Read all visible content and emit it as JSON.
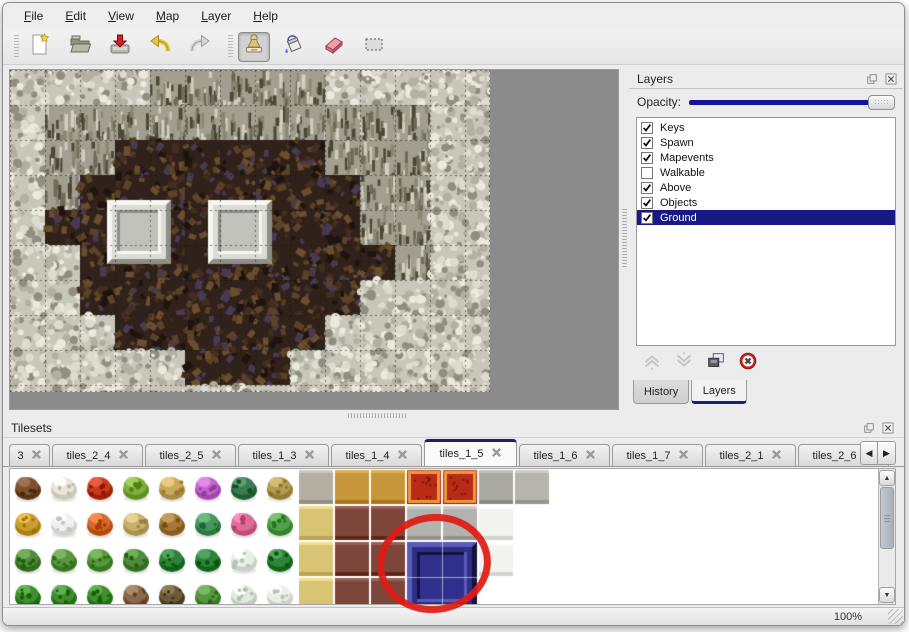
{
  "menu": {
    "items": [
      "File",
      "Edit",
      "View",
      "Map",
      "Layer",
      "Help"
    ]
  },
  "toolbar": {
    "groups": [
      [
        "new-file",
        "open-file",
        "save-file",
        "undo",
        "redo"
      ],
      [
        "stamp-tool",
        "fill-tool",
        "eraser-tool",
        "select-tool"
      ]
    ],
    "active_tool": "stamp-tool"
  },
  "layers_panel": {
    "title": "Layers",
    "opacity_label": "Opacity:",
    "float_icon": "float-icon",
    "close_icon": "close-icon",
    "layers": [
      {
        "label": "Keys",
        "checked": true,
        "selected": false
      },
      {
        "label": "Spawn",
        "checked": true,
        "selected": false
      },
      {
        "label": "Mapevents",
        "checked": true,
        "selected": false
      },
      {
        "label": "Walkable",
        "checked": false,
        "selected": false
      },
      {
        "label": "Above",
        "checked": true,
        "selected": false
      },
      {
        "label": "Objects",
        "checked": true,
        "selected": false
      },
      {
        "label": "Ground",
        "checked": true,
        "selected": true
      }
    ],
    "buttons": [
      {
        "icon": "move-up-icon",
        "enabled": false
      },
      {
        "icon": "move-down-icon",
        "enabled": false
      },
      {
        "icon": "duplicate-icon",
        "enabled": true
      },
      {
        "icon": "delete-icon",
        "enabled": true
      }
    ],
    "tabs": [
      "History",
      "Layers"
    ],
    "active_tab": "Layers"
  },
  "tilesets_panel": {
    "title": "Tilesets",
    "tabs": [
      "3",
      "tiles_2_4",
      "tiles_2_5",
      "tiles_1_3",
      "tiles_1_4",
      "tiles_1_5",
      "tiles_1_6",
      "tiles_1_7",
      "tiles_2_1",
      "tiles_2_6"
    ],
    "active_tab": "tiles_1_5",
    "scroll_left": "◀",
    "scroll_right": "▶"
  },
  "status_bar": {
    "zoom": "100%"
  },
  "colors": {
    "selection_navy": "#191985",
    "slider_navy": "#15159c",
    "annotation_red": "#de1a12",
    "viewport_gray": "#8b8b8b"
  },
  "map_view": {
    "tile_size": 35,
    "width": 480,
    "height": 322,
    "grid": [
      "SSSSWWWWWSSSSS",
      "SWWWWWWWWWWWSS",
      "SWWFFFFFFWWWSS",
      "SWFFFFFFFFWWSS",
      "SFFFFFFFFFWWSS",
      "SSFFFFFFFFFWSS",
      "SSFFFFFFFFSSSS",
      "SSSFFFFFFSSSSS",
      "SSSSSFFFSSSSSS",
      "SSSSSSSSSSSSSS"
    ],
    "platforms": [
      {
        "x": 97,
        "y": 130,
        "w": 64,
        "h": 64
      },
      {
        "x": 198,
        "y": 130,
        "w": 64,
        "h": 64
      }
    ]
  },
  "tileset_view": {
    "cell": 36,
    "rows": [
      [
        {
          "t": "b",
          "c": "#7a5230"
        },
        {
          "t": "b",
          "c": "#e9e5da"
        },
        {
          "t": "b",
          "c": "#c23d1e"
        },
        {
          "t": "b",
          "c": "#7fae3f"
        },
        {
          "t": "b",
          "c": "#c9a95b"
        },
        {
          "t": "b",
          "c": "#c266c9"
        },
        {
          "t": "b",
          "c": "#3c7c4e"
        },
        {
          "t": "b",
          "c": "#b49b52"
        },
        {
          "t": "f",
          "c": "#b3afa2"
        },
        {
          "t": "f",
          "c": "#c8963a"
        },
        {
          "t": "f",
          "c": "#c8963a"
        },
        {
          "t": "c",
          "c": "#b92b17"
        },
        {
          "t": "c",
          "c": "#b92b17"
        },
        {
          "t": "f",
          "c": "#a9a9a1"
        },
        {
          "t": "f",
          "c": "#b5b5ad"
        }
      ],
      [
        {
          "t": "b",
          "c": "#c99e2f"
        },
        {
          "t": "b",
          "c": "#f0f0ed"
        },
        {
          "t": "b",
          "c": "#d4692b"
        },
        {
          "t": "b",
          "c": "#c7af6e"
        },
        {
          "t": "b",
          "c": "#a5793c"
        },
        {
          "t": "b",
          "c": "#47965c"
        },
        {
          "t": "b",
          "c": "#dd6b97"
        },
        {
          "t": "b",
          "c": "#55a04a"
        },
        {
          "t": "f",
          "c": "#d9c476"
        },
        {
          "t": "f",
          "c": "#7c463a"
        },
        {
          "t": "f",
          "c": "#7c463a"
        },
        {
          "t": "f",
          "c": "#b2b2ae"
        },
        {
          "t": "f",
          "c": "#b2b2ae"
        },
        {
          "t": "f",
          "c": "#f2f2ee"
        },
        null
      ],
      [
        {
          "t": "b",
          "c": "#4f8c3b"
        },
        {
          "t": "b",
          "c": "#57963f"
        },
        {
          "t": "b",
          "c": "#57963f"
        },
        {
          "t": "b",
          "c": "#4f8c3b"
        },
        {
          "t": "b",
          "c": "#2f8339"
        },
        {
          "t": "b",
          "c": "#2f8339"
        },
        {
          "t": "b",
          "c": "#e8efe6"
        },
        {
          "t": "b",
          "c": "#2f8339"
        },
        {
          "t": "f",
          "c": "#d9c476"
        },
        {
          "t": "f",
          "c": "#7c463a"
        },
        {
          "t": "f",
          "c": "#7c463a"
        },
        {
          "t": "B"
        },
        {
          "t": "B"
        },
        {
          "t": "f",
          "c": "#f2f2ee"
        },
        null
      ],
      [
        {
          "t": "b",
          "c": "#3f8f30"
        },
        {
          "t": "b",
          "c": "#3f8f30"
        },
        {
          "t": "b",
          "c": "#3f8f30"
        },
        {
          "t": "b",
          "c": "#8a6a4a"
        },
        {
          "t": "b",
          "c": "#6b5a38"
        },
        {
          "t": "b",
          "c": "#57963f"
        },
        {
          "t": "b",
          "c": "#dfe9df"
        },
        {
          "t": "b",
          "c": "#e9efe7"
        },
        {
          "t": "f",
          "c": "#d9c476"
        },
        {
          "t": "f",
          "c": "#7c463a"
        },
        {
          "t": "f",
          "c": "#7c463a"
        },
        {
          "t": "B"
        },
        {
          "t": "B"
        },
        null,
        null
      ]
    ],
    "blue_block": {
      "col": 11,
      "row": 2,
      "cols": 2,
      "rows": 2
    }
  },
  "annotation": {
    "shape": "ellipse",
    "color": "#de1a12"
  }
}
